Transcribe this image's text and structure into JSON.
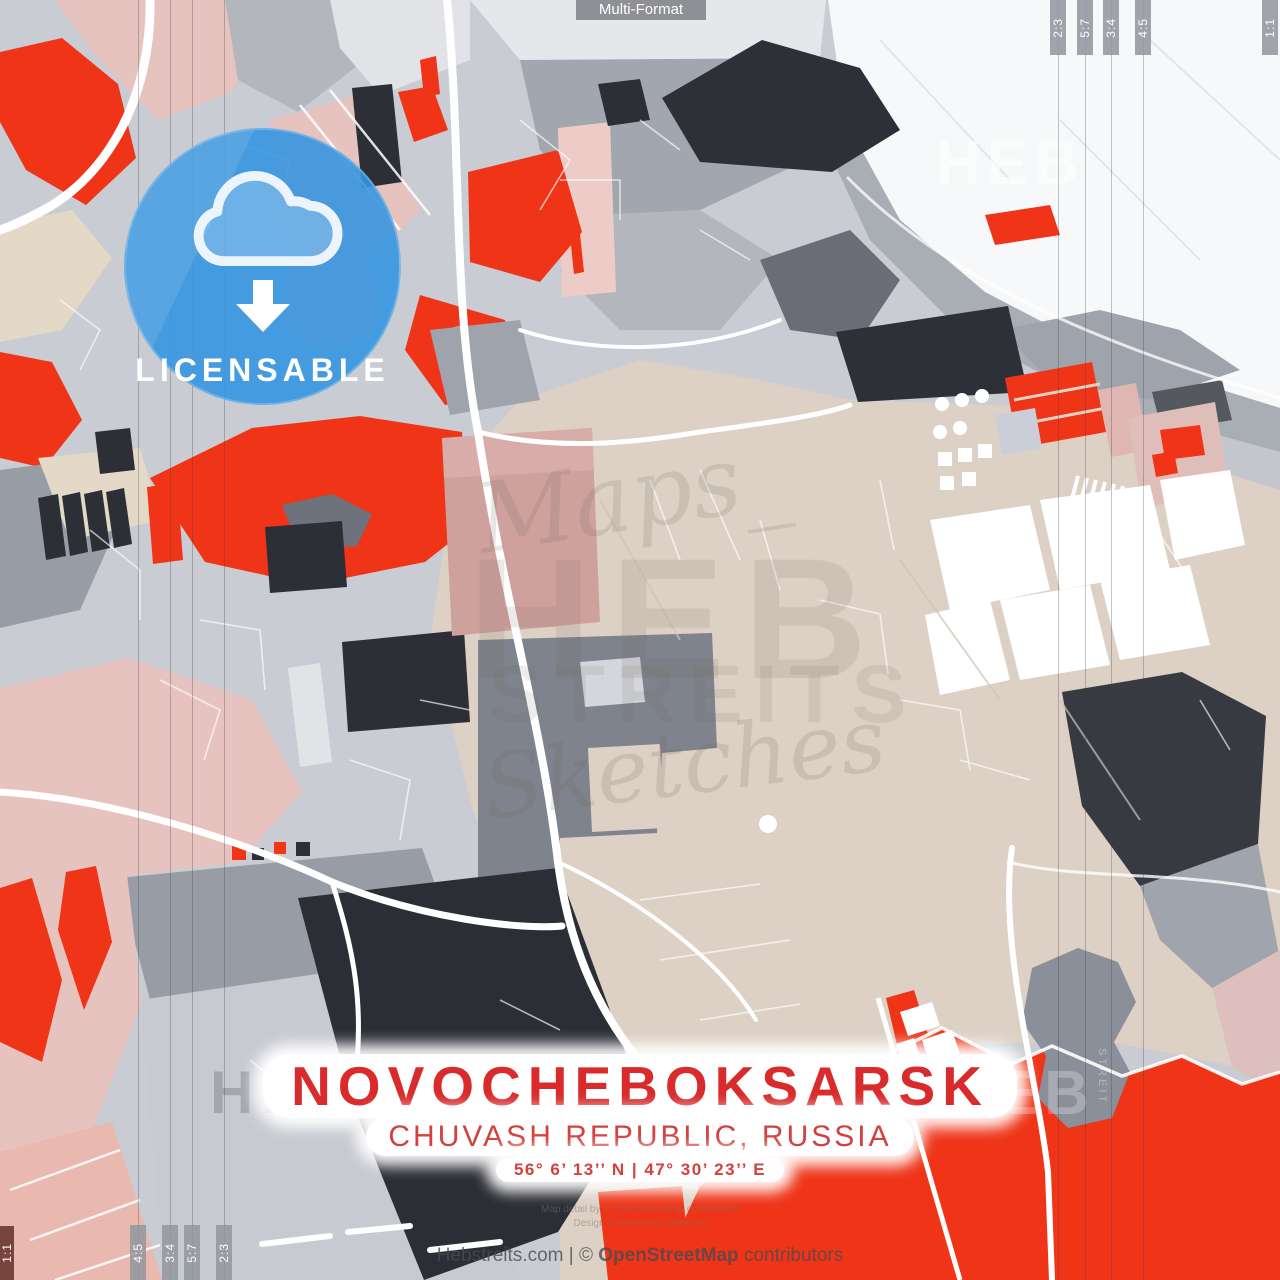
{
  "page": {
    "type_label": "Multi-Format"
  },
  "format_marks": {
    "top_right": [
      "2:3",
      "5:7",
      "3:4",
      "4:5"
    ],
    "right_edge": "1:1",
    "bottom_left": [
      "4:5",
      "3:4",
      "5:7",
      "2:3"
    ],
    "left_edge": "1:1"
  },
  "badge": {
    "label": "LICENSABLE",
    "icon": "cloud-download-icon",
    "color": "#3a99e4"
  },
  "title_block": {
    "city": "NOVOCHEBOKSARSK",
    "region": "CHUVASH REPUBLIC, RUSSIA",
    "coordinates": "56° 6’ 13’’ N | 47° 30’ 23’’ E",
    "accent_color": "#d92b2b"
  },
  "watermarks": {
    "script_top": "Maps_",
    "brand_big": "HEB",
    "brand_mid": "STREITS",
    "script_bottom": "Sketches",
    "side_vertical": "STREIT",
    "corner_top_right": "HEB",
    "corner_bottom_right": "HEB",
    "corner_bottom_left": "HEB"
  },
  "footer": {
    "fineprint_line1": "Map detail by © OpenStreetMap contributors",
    "fineprint_line2": "Design © Hebstreits Sketches",
    "credit_site": "Hebstreits.com",
    "credit_sep": "|",
    "credit_copy": "©",
    "credit_osm": "OpenStreetMap",
    "credit_suffix": "contributors"
  },
  "map": {
    "palette": {
      "red": "#ef3418",
      "charcoal": "#2d2f36",
      "beige": "#ddd1c5",
      "pink": "#e7c3bf",
      "rose": "#cfa19d",
      "salmon": "#e9b9b0",
      "water_white": "#f7f8f9",
      "gray": "#b3b6bd",
      "badge_blue": "#3a99e4"
    }
  }
}
